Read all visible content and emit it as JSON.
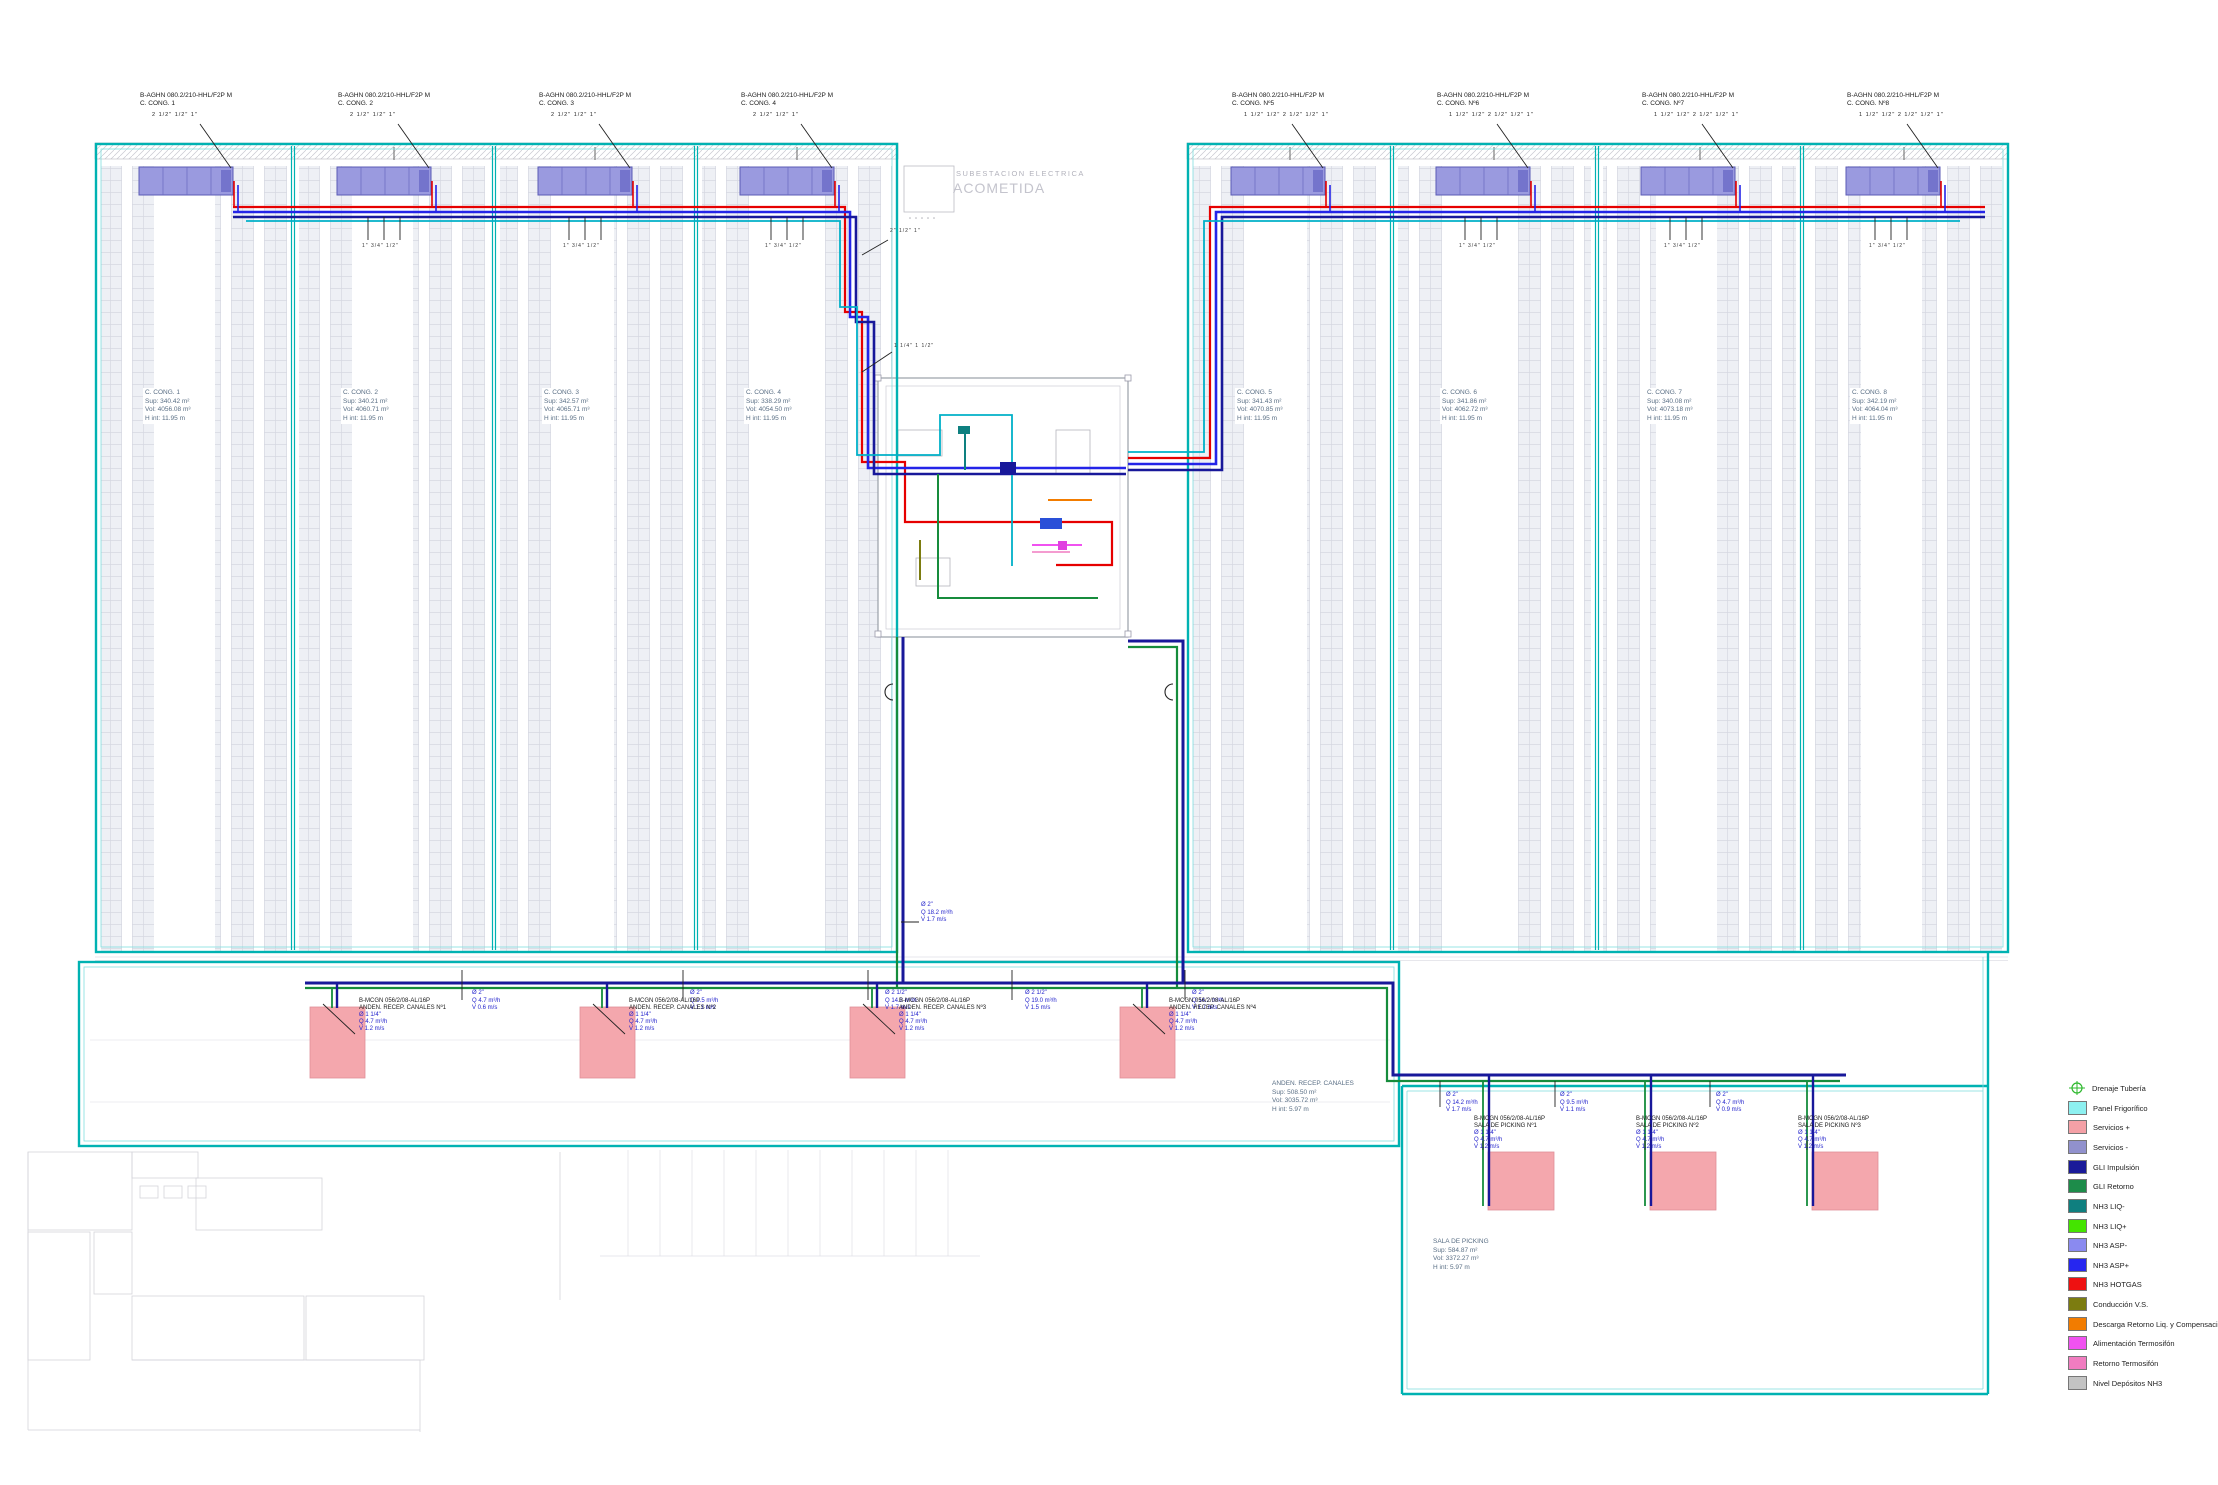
{
  "legend": {
    "items": [
      {
        "label": "Drenaje Tubería",
        "color": "#2db82d"
      },
      {
        "label": "Panel Frigorífico",
        "color": "#8df0f0"
      },
      {
        "label": "Servicios +",
        "color": "#f4a0a6"
      },
      {
        "label": "Servicios -",
        "color": "#9191cd"
      },
      {
        "label": "GLI Impulsión",
        "color": "#1a1a99"
      },
      {
        "label": "GLI Retorno",
        "color": "#1d8c4a"
      },
      {
        "label": "NH3 LIQ-",
        "color": "#0f7f7f"
      },
      {
        "label": "NH3 LIQ+",
        "color": "#44e400"
      },
      {
        "label": "NH3 ASP-",
        "color": "#8a8af0"
      },
      {
        "label": "NH3 ASP+",
        "color": "#2626f0"
      },
      {
        "label": "NH3 HOTGAS",
        "color": "#ee1111"
      },
      {
        "label": "Conducción V.S.",
        "color": "#7c7c10"
      },
      {
        "label": "Descarga Retorno Liq. y Compensación",
        "color": "#f27c00"
      },
      {
        "label": "Alimentación Termosifón",
        "color": "#f052f0"
      },
      {
        "label": "Retorno Termosifón",
        "color": "#f07cc0"
      },
      {
        "label": "Nivel Depósitos NH3",
        "color": "#c3c3c3"
      }
    ]
  },
  "chambers": [
    {
      "unit": "B-AGHN 080.2/210-HHL/F2P M",
      "name": "C. CONG. 1",
      "sizes": "2 1/2\" 1/2\" 1\"",
      "iname": "C. CONG. 1",
      "sup": "Sup: 340.42 m²",
      "vol": "Vol: 4056.08 m³",
      "h": "H int: 11.95 m"
    },
    {
      "unit": "B-AGHN 080.2/210-HHL/F2P M",
      "name": "C. CONG. 2",
      "sizes": "2 1/2\" 1/2\" 1\"",
      "iname": "C. CONG. 2",
      "sup": "Sup: 340.21 m²",
      "vol": "Vol: 4060.71 m³",
      "h": "H int: 11.95 m"
    },
    {
      "unit": "B-AGHN 080.2/210-HHL/F2P M",
      "name": "C. CONG. 3",
      "sizes": "2 1/2\" 1/2\" 1\"",
      "iname": "C. CONG. 3",
      "sup": "Sup: 342.57 m²",
      "vol": "Vol: 4065.71 m³",
      "h": "H int: 11.95 m"
    },
    {
      "unit": "B-AGHN 080.2/210-HHL/F2P M",
      "name": "C. CONG. 4",
      "sizes": "2 1/2\" 1/2\" 1\"",
      "iname": "C. CONG. 4",
      "sup": "Sup: 338.29 m²",
      "vol": "Vol: 4054.50 m³",
      "h": "H int: 11.95 m"
    },
    {
      "unit": "B-AGHN 080.2/210-HHL/F2P M",
      "name": "C. CONG. Nº5",
      "sizes": "1 1/2\" 1/2\" 2 1/2\" 1/2\" 1\"",
      "iname": "C. CONG. 5",
      "sup": "Sup: 341.43 m²",
      "vol": "Vol: 4070.85 m³",
      "h": "H int: 11.95 m"
    },
    {
      "unit": "B-AGHN 080.2/210-HHL/F2P M",
      "name": "C. CONG. Nº6",
      "sizes": "1 1/2\" 1/2\" 2 1/2\" 1/2\" 1\"",
      "iname": "C. CONG. 6",
      "sup": "Sup: 341.86 m²",
      "vol": "Vol: 4062.72 m³",
      "h": "H int: 11.95 m"
    },
    {
      "unit": "B-AGHN 080.2/210-HHL/F2P M",
      "name": "C. CONG. Nº7",
      "sizes": "1 1/2\" 1/2\" 2 1/2\" 1/2\" 1\"",
      "iname": "C. CONG. 7",
      "sup": "Sup: 340.08 m²",
      "vol": "Vol: 4073.18 m³",
      "h": "H int: 11.95 m"
    },
    {
      "unit": "B-AGHN 080.2/210-HHL/F2P M",
      "name": "C. CONG. Nº8",
      "sizes": "1 1/2\" 1/2\" 2 1/2\" 1/2\" 1\"",
      "iname": "C. CONG. 8",
      "sup": "Sup: 342.19 m²",
      "vol": "Vol: 4064.04 m³",
      "h": "H int: 11.95 m"
    }
  ],
  "center": {
    "line1": "SUBESTACION ELECTRICA",
    "line2": "ACOMETIDA"
  },
  "areas": {
    "anden": {
      "title": "ANDEN. RECEP. CANALES",
      "sup": "Sup: 508.50 m²",
      "vol": "Vol: 3035.72 m³",
      "h": "H int: 5.97 m"
    },
    "picking": {
      "title": "SALA DE PICKING",
      "sup": "Sup: 584.87 m²",
      "vol": "Vol: 3372.27 m³",
      "h": "H int: 5.97 m"
    }
  },
  "anden_boxes": [
    {
      "model": "B-MCGN 056/2/08-AL/16P",
      "name": "ANDEN. RECEP. CANALES Nº1",
      "d": "Ø 1 1/4\"",
      "q": "Q 4.7 m³/h",
      "v": "V 1.2 m/s"
    },
    {
      "model": "B-MCGN 056/2/08-AL/16P",
      "name": "ANDEN. RECEP. CANALES Nº2",
      "d": "Ø 1 1/4\"",
      "q": "Q 4.7 m³/h",
      "v": "V 1.2 m/s"
    },
    {
      "model": "B-MCGN 056/2/08-AL/16P",
      "name": "ANDEN. RECEP. CANALES Nº3",
      "d": "Ø 1 1/4\"",
      "q": "Q 4.7 m³/h",
      "v": "V 1.2 m/s"
    },
    {
      "model": "B-MCGN 056/2/08-AL/16P",
      "name": "ANDEN. RECEP. CANALES Nº4",
      "d": "Ø 1 1/4\"",
      "q": "Q 4.7 m³/h",
      "v": "V 1.2 m/s"
    }
  ],
  "picking_boxes": [
    {
      "model": "B-MCGN 056/2/08-AL/16P",
      "name": "SALA DE PICKING Nº1",
      "d": "Ø 1 1/4\"",
      "q": "Q 4.7 m³/h",
      "v": "V 1.2 m/s"
    },
    {
      "model": "B-MCGN 056/2/08-AL/16P",
      "name": "SALA DE PICKING Nº2",
      "d": "Ø 1 1/4\"",
      "q": "Q 4.7 m³/h",
      "v": "V 1.2 m/s"
    },
    {
      "model": "B-MCGN 056/2/08-AL/16P",
      "name": "SALA DE PICKING Nº3",
      "d": "Ø 1 1/4\"",
      "q": "Q 4.7 m³/h",
      "v": "V 1.2 m/s"
    }
  ],
  "pipe_labels": [
    {
      "d": "Ø 2\"",
      "q": "Q 4.7 m³/h",
      "v": "V 0.6 m/s"
    },
    {
      "d": "Ø 2\"",
      "q": "Q 9.5 m³/h",
      "v": "V 1.1 m/s"
    },
    {
      "d": "Ø 2 1/2\"",
      "q": "Q 14.2 m³/h",
      "v": "V 1.7 m/s"
    },
    {
      "d": "Ø 2 1/2\"",
      "q": "Q 19.0 m³/h",
      "v": "V 1.5 m/s"
    },
    {
      "d": "Ø 2\"",
      "q": "Q 14.2 m³/h",
      "v": "V 1.7 m/s"
    },
    {
      "d": "Ø 2\"",
      "q": "Q 18.2 m³/h",
      "v": "V 1.7 m/s"
    },
    {
      "d": "Ø 2\"",
      "q": "Q 14.2 m³/h",
      "v": "V 1.7 m/s"
    },
    {
      "d": "Ø 2\"",
      "q": "Q 9.5 m³/h",
      "v": "V 1.1 m/s"
    },
    {
      "d": "Ø 2\"",
      "q": "Q 4.7 m³/h",
      "v": "V 0.9 m/s"
    }
  ],
  "misc": {
    "stub_sizes": "1\" 3/4\" 1/2\"",
    "branch_sizes": "1 1/4\" 1 1/2\"",
    "branch_sizes2": "2\" 1/2\" 1\""
  }
}
